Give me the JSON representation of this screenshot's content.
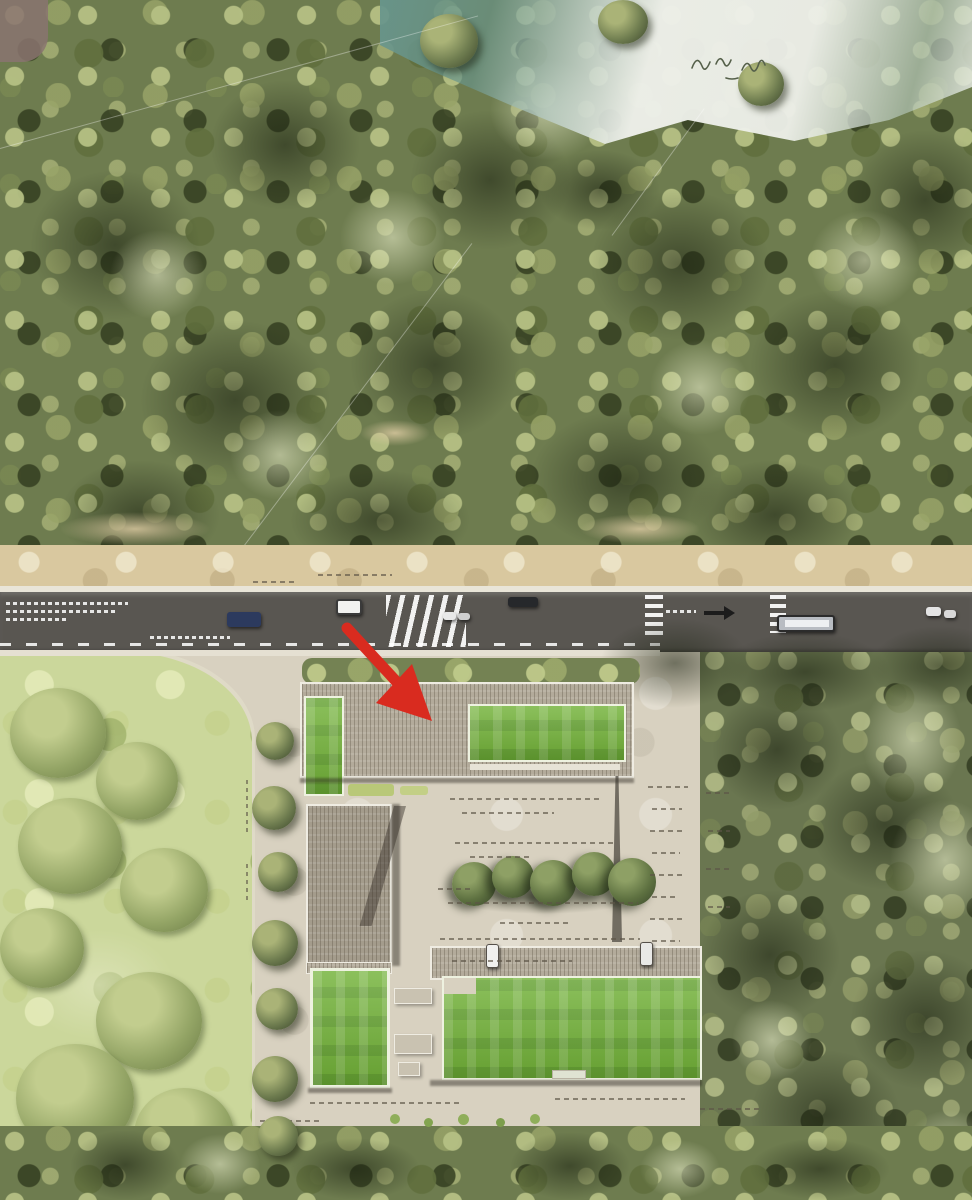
{
  "scene": {
    "description": "Aerial architectural site-plan rendering: dense forest and shoreline at top, an east-west road with vehicles and crosswalks, and a courtyard building complex with green roofs below, marked by a red locator arrow",
    "colors": {
      "forest_base": "#6e7c4f",
      "forest_light": "#aab377",
      "forest_dark": "#39442a",
      "park_lawn": "#cbd79b",
      "sand": "#d9c89f",
      "road": "#595651",
      "pavement": "#d8d1c0",
      "roof_gray": "#b3ab9b",
      "roof_green": "#72b238",
      "water_teal": "#68958c",
      "foam_white": "#eef0ea",
      "arrow_red": "#d92b1f",
      "vehicle_blue": "#2c3a5e",
      "vehicle_dark": "#26282b",
      "bus_gray": "#b8bcc2"
    },
    "road_features": {
      "crosswalk_count": 3,
      "vehicle_count": 8,
      "direction_arrow": "black arrow pointing right painted on eastbound lane",
      "center_line": "dashed white"
    },
    "buildings": {
      "green_roof_count": 4,
      "courtyard_tree_row_count": 5,
      "note": "all plan dimension labels are illegible micro-text rendered as dash marks"
    },
    "annotation_arrow": {
      "color_hex": "#d92b1f",
      "points_to": "gray roof of the north building slab"
    }
  }
}
